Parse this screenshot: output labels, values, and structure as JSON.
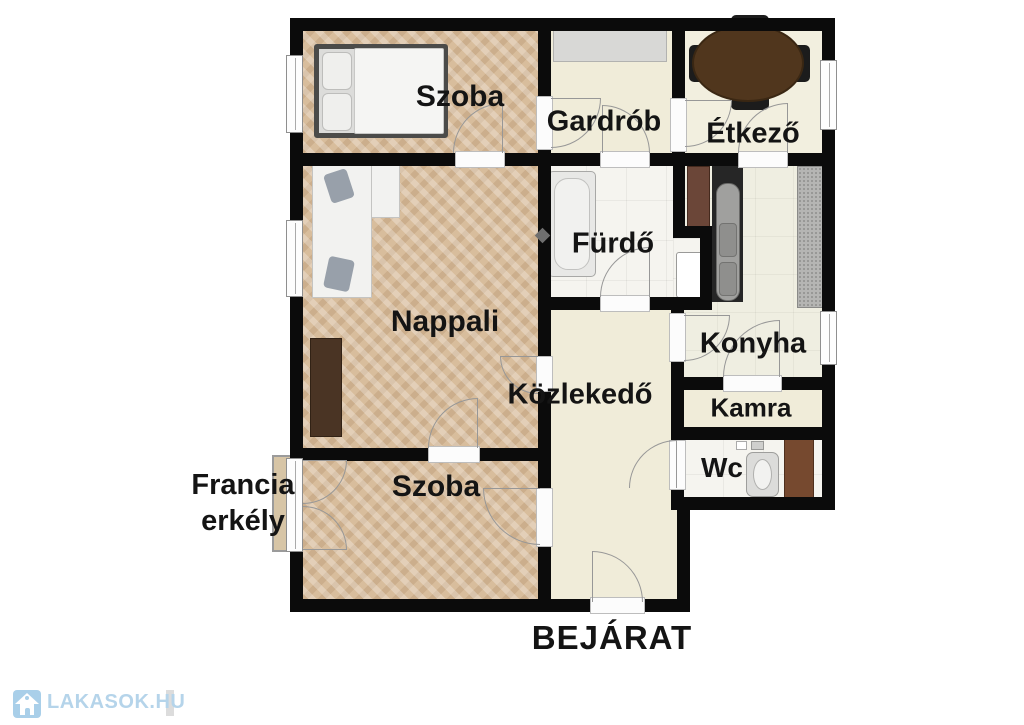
{
  "plan": {
    "rooms": [
      {
        "id": "szoba-top",
        "label": "Szoba"
      },
      {
        "id": "gardrob",
        "label": "Gardrób"
      },
      {
        "id": "etkezo",
        "label": "Étkező"
      },
      {
        "id": "furdo",
        "label": "Fürdő"
      },
      {
        "id": "nappali",
        "label": "Nappali"
      },
      {
        "id": "konyha",
        "label": "Konyha"
      },
      {
        "id": "kozlekedo",
        "label": "Közlekedő"
      },
      {
        "id": "kamra",
        "label": "Kamra"
      },
      {
        "id": "wc",
        "label": "Wc"
      },
      {
        "id": "szoba-bottom",
        "label": "Szoba"
      }
    ],
    "outside": {
      "balcony_line1": "Francia",
      "balcony_line2": "erkély",
      "entrance": "BEJÁRAT"
    }
  },
  "watermark": {
    "text": "LAKASOK.HU"
  },
  "colors": {
    "wall": "#0b0b0b",
    "wood_floor": "#d8bd9c",
    "cream_floor": "#f0ecd9",
    "tile_floor": "#f5f4ef",
    "watermark_blue": "#b5d4ea",
    "cabinet_brown": "#4a3424",
    "table_brown": "#50361d",
    "fridge_brown": "#6b4638",
    "washer_brown": "#76492f"
  }
}
